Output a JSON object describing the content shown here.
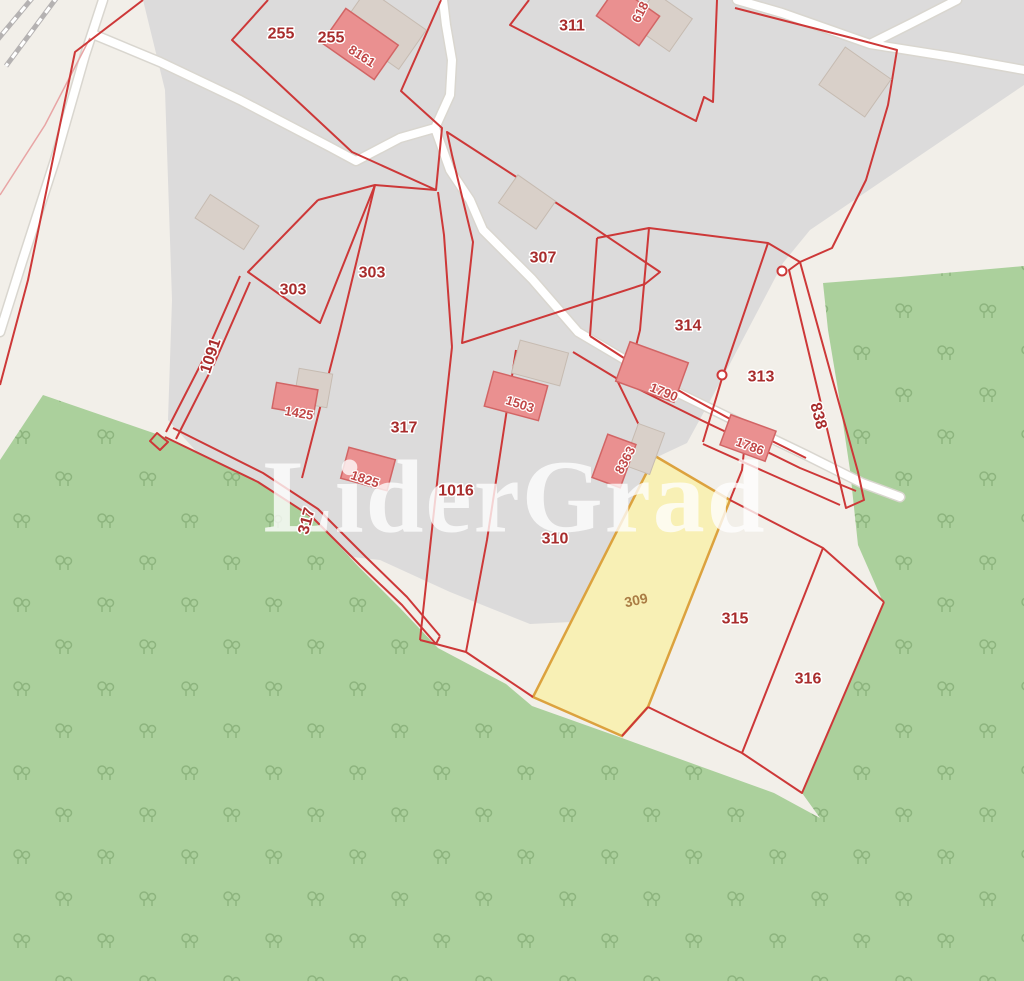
{
  "watermark": "LiderGrad",
  "map": {
    "colors": {
      "background": "#f2efe9",
      "residential": "#dcdbdb",
      "forest": "#abd09c",
      "tree_glyph": "#79a26b",
      "road": "#ffffff",
      "road_casing": "#d9d6cf",
      "railway": "#b5b2b2",
      "parcel_line": "#cd3838",
      "parcel_line_light": "#e8a5a5",
      "parcel_label": "#a82c2c",
      "building_fill": "#ea9090",
      "building_outline": "#d26565",
      "building_label": "#c14747",
      "osm_building_fill": "#d9d0c9",
      "osm_building_outline": "#c6bbb1",
      "highlight_fill": "#f8f0ad",
      "highlight_outline": "#dca23e",
      "highlight_label": "#aa7c44",
      "watermark_color": "#ffffff"
    },
    "parcel_labels": [
      "255",
      "255",
      "311",
      "303",
      "303",
      "307",
      "314",
      "313",
      "1091",
      "317",
      "317",
      "838",
      "1016",
      "310",
      "315",
      "316"
    ],
    "building_labels": [
      "8161",
      "618",
      "1425",
      "1503",
      "1825",
      "1790",
      "1786",
      "8363"
    ],
    "highlighted_parcel": {
      "label": "309"
    }
  }
}
